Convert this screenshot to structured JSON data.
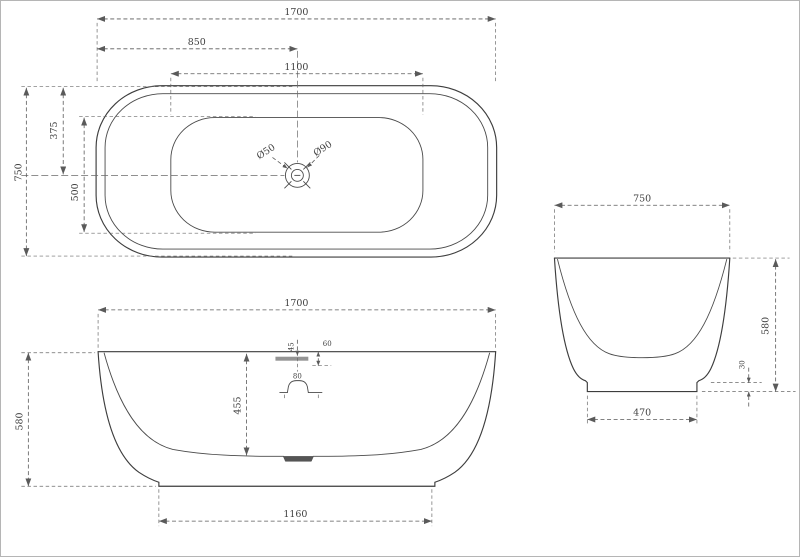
{
  "drawing": {
    "type": "bathtub-three-view-technical-drawing",
    "colors": {
      "background": "#ffffff",
      "outline": "#3d3d3d",
      "dimension_lines": "#5a5a5a",
      "text": "#3f3f3f",
      "overflow_fill": "#949494",
      "drain_recess_fill": "#555555"
    },
    "top_view": {
      "dims": {
        "overall_length": "1700",
        "drain_center_from_left": "850",
        "basin_length": "1100",
        "overall_width": "750",
        "drain_center_from_top": "375",
        "basin_width": "500",
        "drain_diameter_small": "Ø50",
        "drain_diameter_large": "Ø90"
      }
    },
    "front_view": {
      "dims": {
        "overall_length": "1700",
        "overall_height": "580",
        "base_length": "1160",
        "interior_depth": "455",
        "overflow_offset": "45",
        "rim_to_overflow": "60",
        "drain_boss_width": "80"
      }
    },
    "side_view": {
      "dims": {
        "overall_width": "750",
        "overall_height": "580",
        "base_width": "470",
        "foot_height": "30"
      }
    }
  }
}
